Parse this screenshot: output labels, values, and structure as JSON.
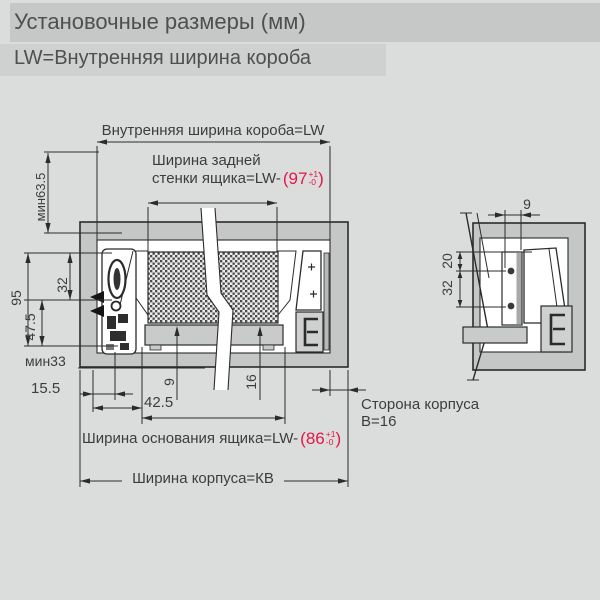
{
  "header": {
    "title": "Установочные размеры (мм)",
    "subtitle": "LW=Внутренняя ширина короба"
  },
  "labels": {
    "lw": "Внутренняя ширина короба=LW",
    "back1": "Ширина задней",
    "back2": "стенки ящика=LW-",
    "back_tol": {
      "open": "(97",
      "plus": "+1",
      "minus": "-0",
      "close": ")"
    },
    "min635": "мин63.5",
    "d95": "95",
    "d475": "47.5",
    "d32": "32",
    "min33": "мин33",
    "d155": "15.5",
    "d425": "42.5",
    "d9": "9",
    "d16": "16",
    "base": "Ширина основания ящика=LW-",
    "base_tol": {
      "open": "(86",
      "plus": "+1",
      "minus": "-0",
      "close": ")"
    },
    "kb": "Ширина корпуса=КВ",
    "side1": "Сторона корпуса",
    "side2": "В=16",
    "r9": "9",
    "r20": "20",
    "r32": "32"
  },
  "colors": {
    "background": "#dbdcdc",
    "header_bar1": "#c6c7c7",
    "header_bar2": "#cfd0d0",
    "line": "#2b2b2b",
    "panel_gray": "#c5c6c6",
    "accent_red": "#e5174a",
    "text": "#3c3d3f"
  }
}
